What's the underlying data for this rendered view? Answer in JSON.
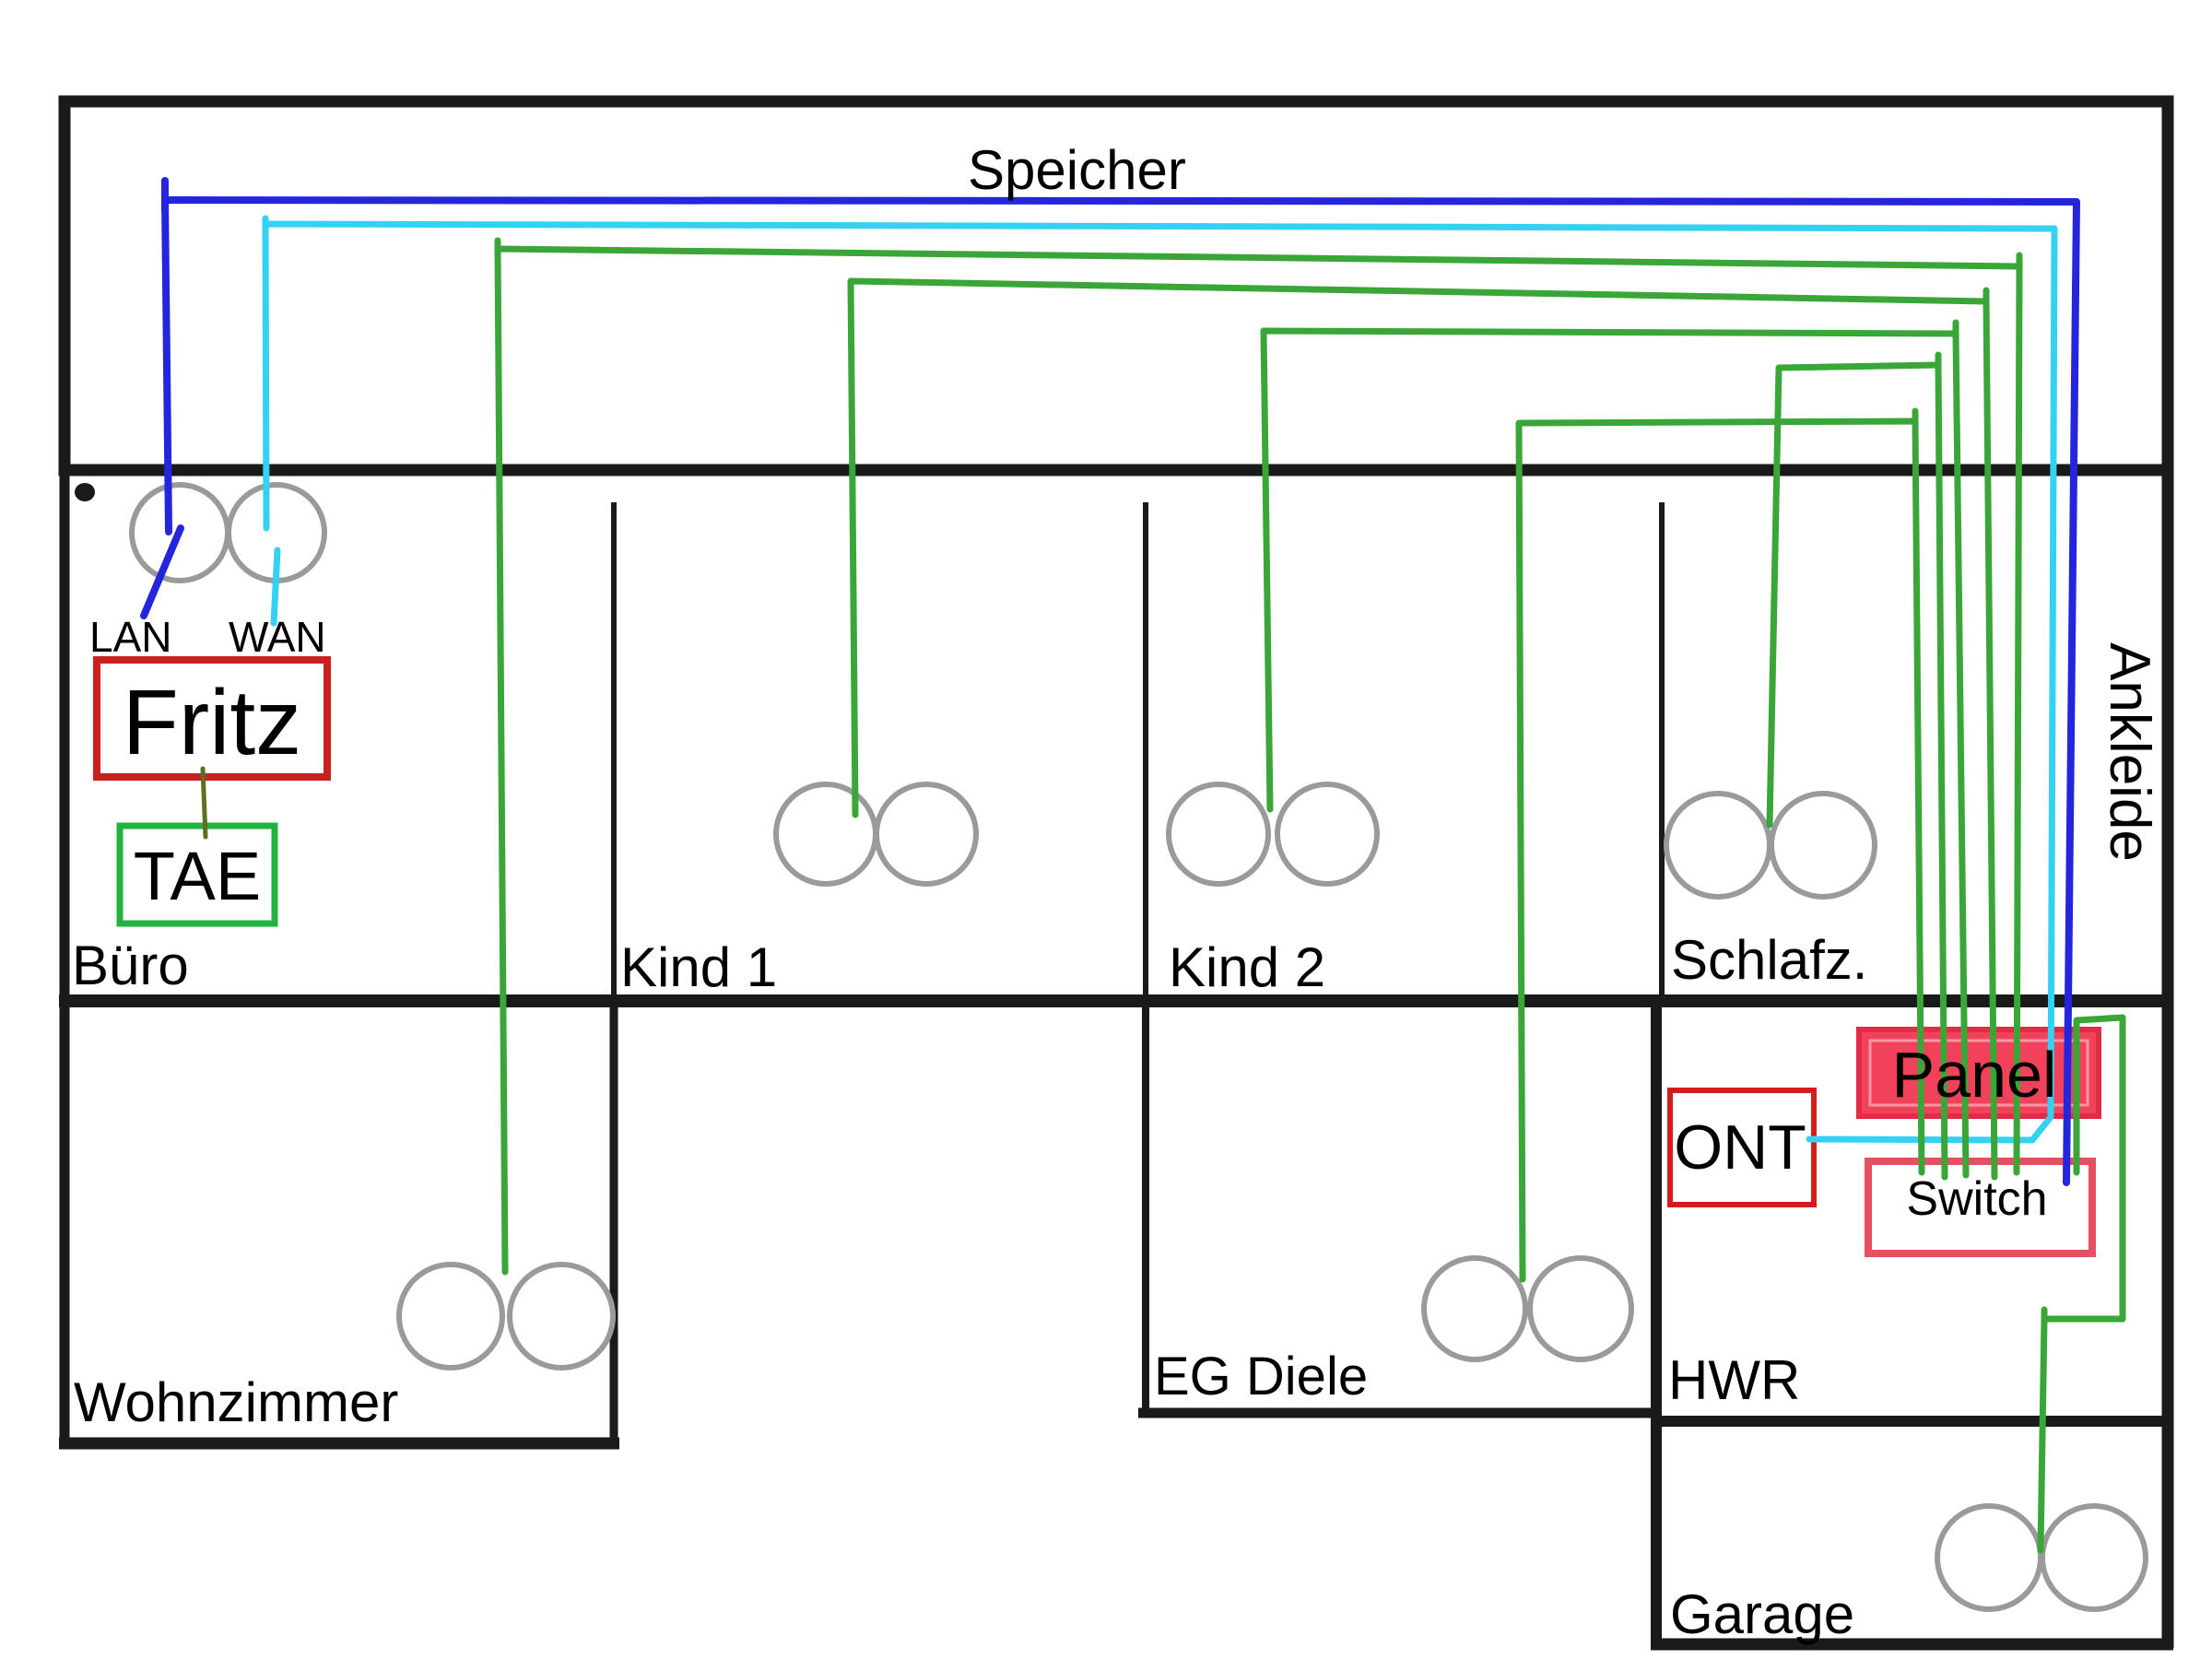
{
  "colors": {
    "wall": "#1a1a1a",
    "socket": "#9a9a9a",
    "label": "#000000",
    "lan_blue": "#2525dd",
    "wan_cyan": "#35d1f2",
    "patch_green": "#3aa637",
    "phone_olive": "#5f6e1f",
    "fritz_red": "#cc1f1f",
    "ont_red": "#d51c1c",
    "tae_green": "#23b240",
    "panel_fill": "#f2415a",
    "panel_border": "#e22b47",
    "switch_border": "#e55061"
  },
  "rooms": {
    "speicher": {
      "label": "Speicher"
    },
    "buero": {
      "label": "Büro"
    },
    "kind1": {
      "label": "Kind 1"
    },
    "kind2": {
      "label": "Kind 2"
    },
    "schlafz": {
      "label": "Schlafz."
    },
    "ankleide": {
      "label": "Ankleide"
    },
    "wohnzimmer": {
      "label": "Wohnzimmer"
    },
    "eg_diele": {
      "label": "EG Diele"
    },
    "hwr": {
      "label": "HWR"
    },
    "garage": {
      "label": "Garage"
    }
  },
  "devices": {
    "fritz": {
      "label": "Fritz"
    },
    "tae": {
      "label": "TAE"
    },
    "ont": {
      "label": "ONT"
    },
    "panel": {
      "label": "Panel"
    },
    "switch": {
      "label": "Switch"
    }
  },
  "router_ports": {
    "lan": {
      "label": "LAN"
    },
    "wan": {
      "label": "WAN"
    }
  },
  "connections": [
    {
      "from": "Fritz LAN (Büro)",
      "to": "Switch (HWR)",
      "color": "blue"
    },
    {
      "from": "ONT (HWR)",
      "to": "Fritz WAN (Büro)",
      "color": "cyan"
    },
    {
      "from": "Switch (HWR)",
      "to": "Wohnzimmer socket",
      "color": "green"
    },
    {
      "from": "Switch (HWR)",
      "to": "Kind 1 socket",
      "color": "green"
    },
    {
      "from": "Switch (HWR)",
      "to": "Kind 2 socket",
      "color": "green"
    },
    {
      "from": "Switch (HWR)",
      "to": "Schlafz. socket",
      "color": "green"
    },
    {
      "from": "Switch (HWR)",
      "to": "EG Diele socket",
      "color": "green"
    },
    {
      "from": "Switch (HWR)",
      "to": "Garage socket",
      "color": "green"
    },
    {
      "from": "Fritz (Büro)",
      "to": "TAE (Büro)",
      "color": "olive"
    }
  ]
}
